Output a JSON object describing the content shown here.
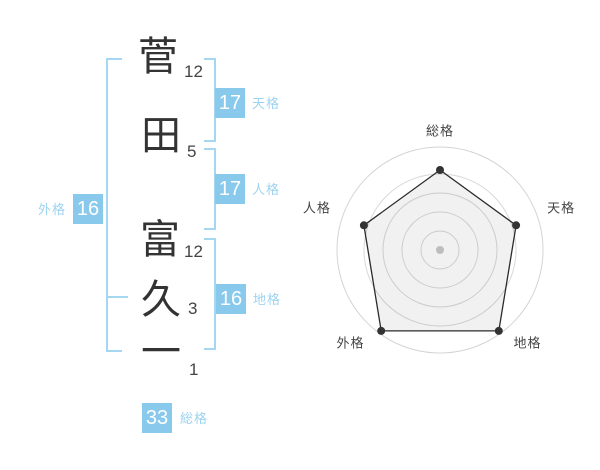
{
  "title": "姓名判断 画数チャート",
  "name_diagram": {
    "characters": [
      {
        "char": "菅",
        "strokes": "12"
      },
      {
        "char": "田",
        "strokes": "5"
      },
      {
        "char": "富",
        "strokes": "12"
      },
      {
        "char": "久",
        "strokes": "3"
      },
      {
        "char": "一",
        "strokes": "1"
      }
    ],
    "scores": {
      "tenkaku": {
        "label": "天格",
        "value": "17"
      },
      "jinkaku": {
        "label": "人格",
        "value": "17"
      },
      "chikaku": {
        "label": "地格",
        "value": "16"
      },
      "gaikaku": {
        "label": "外格",
        "value": "16"
      },
      "soukaku": {
        "label": "総格",
        "value": "33"
      }
    }
  },
  "chart_data": {
    "type": "radar",
    "title": "",
    "categories": [
      "総格",
      "天格",
      "地格",
      "外格",
      "人格"
    ],
    "scores": [
      33,
      17,
      16,
      16,
      17
    ],
    "values_radius_px": [
      80,
      80,
      100,
      100,
      80
    ],
    "outer_ring_radius_px": 103,
    "grid_ring_radii_px": [
      19,
      38,
      57,
      76
    ],
    "legend": "none",
    "grid": "circular"
  },
  "colors": {
    "accent_box": "#89caec",
    "accent_line": "#a5d7f3",
    "accent_label": "#9dd3f1",
    "kanji_text": "#333333",
    "stroke_text": "#444444",
    "radar_grid": "#d8d8d8",
    "radar_outer": "#d4d4d4",
    "radar_polygon_stroke": "#2b2b2b",
    "radar_fill": "rgba(0,0,0,0.055)",
    "radar_dot": "#333333",
    "radar_center_dot": "#bdbdbd"
  }
}
